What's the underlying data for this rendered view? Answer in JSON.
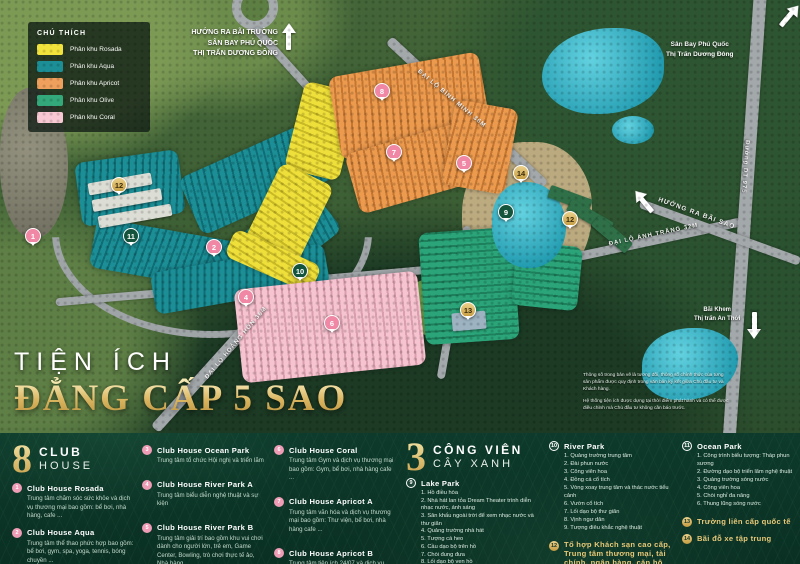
{
  "legend": {
    "title": "CHÚ THÍCH",
    "items": [
      {
        "label": "Phân khu Rosada",
        "color": "#f2e23c"
      },
      {
        "label": "Phân khu Aqua",
        "color": "#1b8e96"
      },
      {
        "label": "Phân khu Apricot",
        "color": "#efa05c"
      },
      {
        "label": "Phân khu Olive",
        "color": "#33a87b"
      },
      {
        "label": "Phân khu Coral",
        "color": "#f8c9d4"
      }
    ]
  },
  "map": {
    "direction_top_center": {
      "l1": "HƯỚNG RA BÃI TRƯỜNG",
      "l2": "SÂN BAY PHÚ QUỐC",
      "l3": "THỊ TRẤN DƯƠNG ĐÔNG"
    },
    "direction_top_right": {
      "l1": "Sân Bay Phú Quốc",
      "l2": "Thị Trấn Dương Đông"
    },
    "direction_bai_sao": "HƯỚNG RA BÃI SAO",
    "direction_bai_khem": {
      "l1": "Bãi Khem",
      "l2": "Thị trấn An Thới"
    },
    "roads": {
      "binh_minh": "ĐẠI LỘ BÌNH MINH 36M",
      "hoang_hon": "ĐẠI LỘ HOÀNG HÔN 36M",
      "anh_trang": "ĐẠI LỘ ÁNH TRĂNG 32M",
      "dt975": "Đường DT 975"
    },
    "disclaimer": {
      "p1": "Thông số trong bản vẽ là tương đối, thông số chính thức của từng sản phẩm được quy định trong văn bản ký kết giữa Chủ đầu tư và Khách hàng.",
      "p2": "Hệ thống tiện ích được dựng tại thời điểm phát hành và có thể được điều chỉnh mà Chủ đầu tư không cần báo trước."
    },
    "markers": [
      {
        "num": "8",
        "type": "coral",
        "x": 382,
        "y": 91
      },
      {
        "num": "7",
        "type": "coral",
        "x": 394,
        "y": 152
      },
      {
        "num": "5",
        "type": "coral",
        "x": 464,
        "y": 163
      },
      {
        "num": "14",
        "type": "gold",
        "x": 521,
        "y": 173
      },
      {
        "num": "12",
        "type": "gold",
        "x": 119,
        "y": 185
      },
      {
        "num": "9",
        "type": "park",
        "x": 506,
        "y": 212
      },
      {
        "num": "12",
        "type": "gold",
        "x": 570,
        "y": 219
      },
      {
        "num": "11",
        "type": "park",
        "x": 131,
        "y": 236
      },
      {
        "num": "1",
        "type": "coral",
        "x": 33,
        "y": 236
      },
      {
        "num": "2",
        "type": "coral",
        "x": 214,
        "y": 247
      },
      {
        "num": "10",
        "type": "park",
        "x": 300,
        "y": 271
      },
      {
        "num": "4",
        "type": "coral",
        "x": 246,
        "y": 297
      },
      {
        "num": "13",
        "type": "gold",
        "x": 468,
        "y": 310
      },
      {
        "num": "6",
        "type": "coral",
        "x": 332,
        "y": 323
      }
    ]
  },
  "title_overlay": {
    "line1": "TIỆN ÍCH",
    "line2": "ĐẲNG CẤP 5 SAO"
  },
  "panel": {
    "club": {
      "number": "8",
      "title_line1": "CLUB",
      "title_line2": "HOUSE",
      "items": [
        {
          "num": "1",
          "name": "Club House Rosada",
          "desc": "Trung tâm chăm sóc sức khỏe và dịch vụ thương mại bao gồm: bể bơi, nhà hàng, cafe ..."
        },
        {
          "num": "2",
          "name": "Club House Aqua",
          "desc": "Trung tâm thể thao phức hợp bao gồm: bể bơi, gym, spa, yoga, tennis, bóng chuyền ..."
        },
        {
          "num": "3",
          "name": "Club House Ocean Park",
          "desc": "Trung tâm tổ chức Hội nghị và triển lãm"
        },
        {
          "num": "4",
          "name": "Club House River Park A",
          "desc": "Trung tâm biểu diễn nghệ thuật và sự kiện"
        },
        {
          "num": "5",
          "name": "Club House River Park B",
          "desc": "Trung tâm giải trí bao gồm khu vui chơi dành cho người lớn, trẻ em, Game Center, Bowling, trò chơi thực tế ảo, Nhà hàng ..."
        },
        {
          "num": "6",
          "name": "Club House Coral",
          "desc": "Trung tâm Gym và dịch vụ thương mại bao gồm: Gym, bể bơi, nhà hàng cafe ..."
        },
        {
          "num": "7",
          "name": "Club House Apricot A",
          "desc": "Trung tâm văn hóa và dịch vụ thương mại bao gồm: Thư viện, bể bơi, nhà hàng cafe ..."
        },
        {
          "num": "8",
          "name": "Club House Apricot B",
          "desc": "Trung tâm tiện ích 24/07 và dịch vụ thương mại bao gồm: nhà hàng cafe ..."
        }
      ]
    },
    "parks": {
      "number": "3",
      "title_line1": "CÔNG VIÊN",
      "title_line2": "CÂY XANH",
      "groups": [
        {
          "num": "9",
          "name": "Lake Park",
          "items": [
            "1. Hồ điều hòa",
            "2. Nhà hát lan tỏa Dream Theater trình diễn nhạc nước, ánh sáng",
            "3. Sân khấu ngoài trời để xem nhạc nước và thư giãn",
            "4. Quảng trường nhà hát",
            "5. Tượng cá heo",
            "6. Cầu dạo bộ trên hồ",
            "7. Chòi đung đưa",
            "8. Lối dạo bộ ven hồ",
            "9. Chòi hến ngọc trai",
            "10. Vườn nướng BBQ"
          ]
        },
        {
          "num": "10",
          "name": "River Park",
          "items": [
            "1. Quảng trường trung tâm",
            "2. Đài phun nước",
            "3. Công viên hoa",
            "4. Đồng cá cổ tích",
            "5. Vòng xoay trung tâm và thác nước tiểu cảnh",
            "6. Vườn cổ tích",
            "7. Lối dạo bộ thư giãn",
            "8. Vịnh ngư dân",
            "9. Tượng điêu khắc nghệ thuật"
          ]
        },
        {
          "num": "11",
          "name": "Ocean Park",
          "items": [
            "1. Công trình biểu tượng: Tháp phun sương",
            "2. Đường dạo bộ triển lãm nghệ thuật",
            "3. Quảng trường sóng nước",
            "4. Công viên hoa",
            "5. Chòi nghỉ đa năng",
            "6. Thung lũng sóng nước"
          ]
        }
      ]
    },
    "extras": {
      "hotel": {
        "num": "12",
        "title": "Tổ hợp Khách sạn cao cấp, Trung tâm thương mại, tài chính, ngân hàng, căn hộ",
        "sub1": "01 Khách sạn cao cấp",
        "sub2": "07 Trung tâm thương mại tài chính và căn hộ cao tầng"
      },
      "school": {
        "num": "13",
        "title": "Trường liên cấp quốc tế"
      },
      "parking": {
        "num": "14",
        "title": "Bãi đỗ xe tập trung"
      }
    }
  }
}
